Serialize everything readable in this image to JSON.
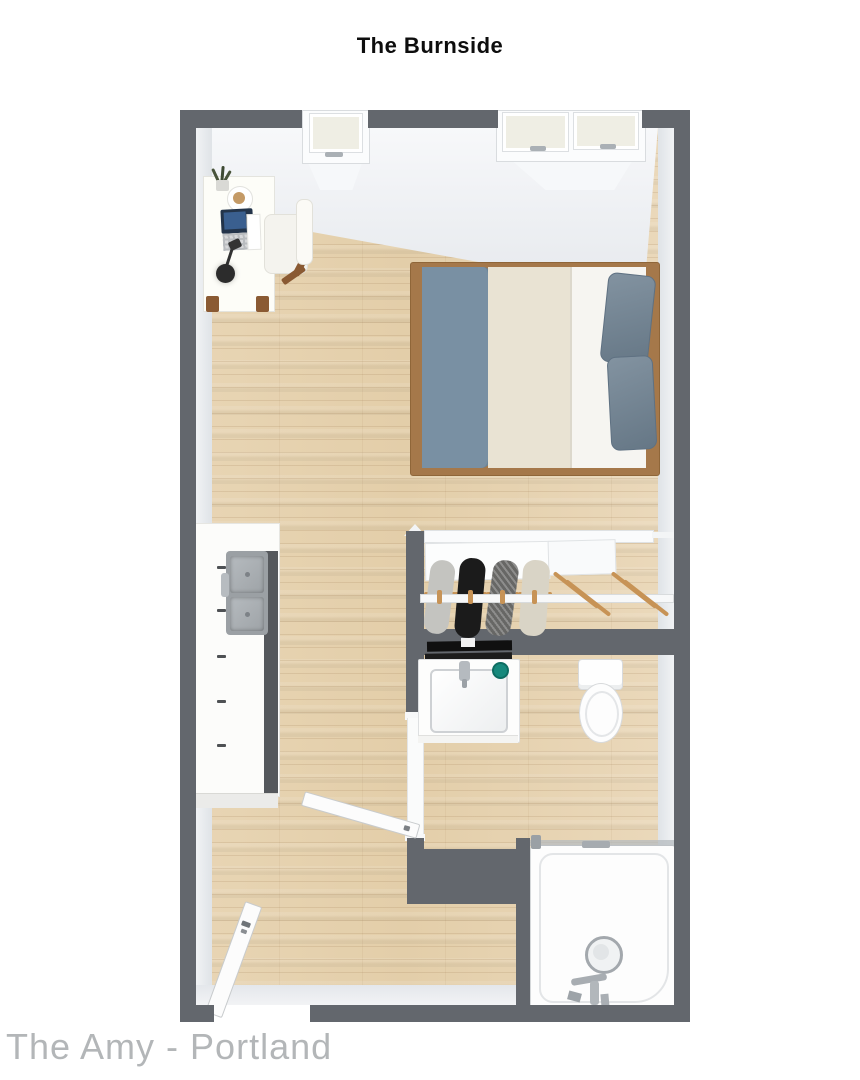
{
  "title": "The Burnside",
  "watermark": "The Amy - Portland",
  "colors": {
    "wall": "#63676d",
    "floor": "#e6d1ae",
    "wood": "#a5784a",
    "blanket": "#7990a3",
    "duvet": "#e9e3d3",
    "sheet": "#f6f5f1",
    "pillow": "#6e8191",
    "steel": "#9ba0a4",
    "steel-dark": "#55585c",
    "teal": "#17897c",
    "hanger": "#c79356",
    "cream": "#efeee4",
    "ink": "#0d0d0d",
    "watermark": "#b3b6b8"
  },
  "icons": {
    "bed": "queen-bed-top-view",
    "desk": "desk-with-laptop-lamp-plant-coffee",
    "chair": "desk-chair",
    "kitchen": "kitchen-counter-with-double-sink",
    "closet": "sliding-door-closet-with-hanging-clothes",
    "vanity": "bathroom-sink-vanity-with-towel-bar",
    "toilet": "toilet-top-view",
    "shower": "walk-in-shower-with-glass-door",
    "windows": "top-wall-windows",
    "doors": "entry-door-and-bathroom-door"
  }
}
